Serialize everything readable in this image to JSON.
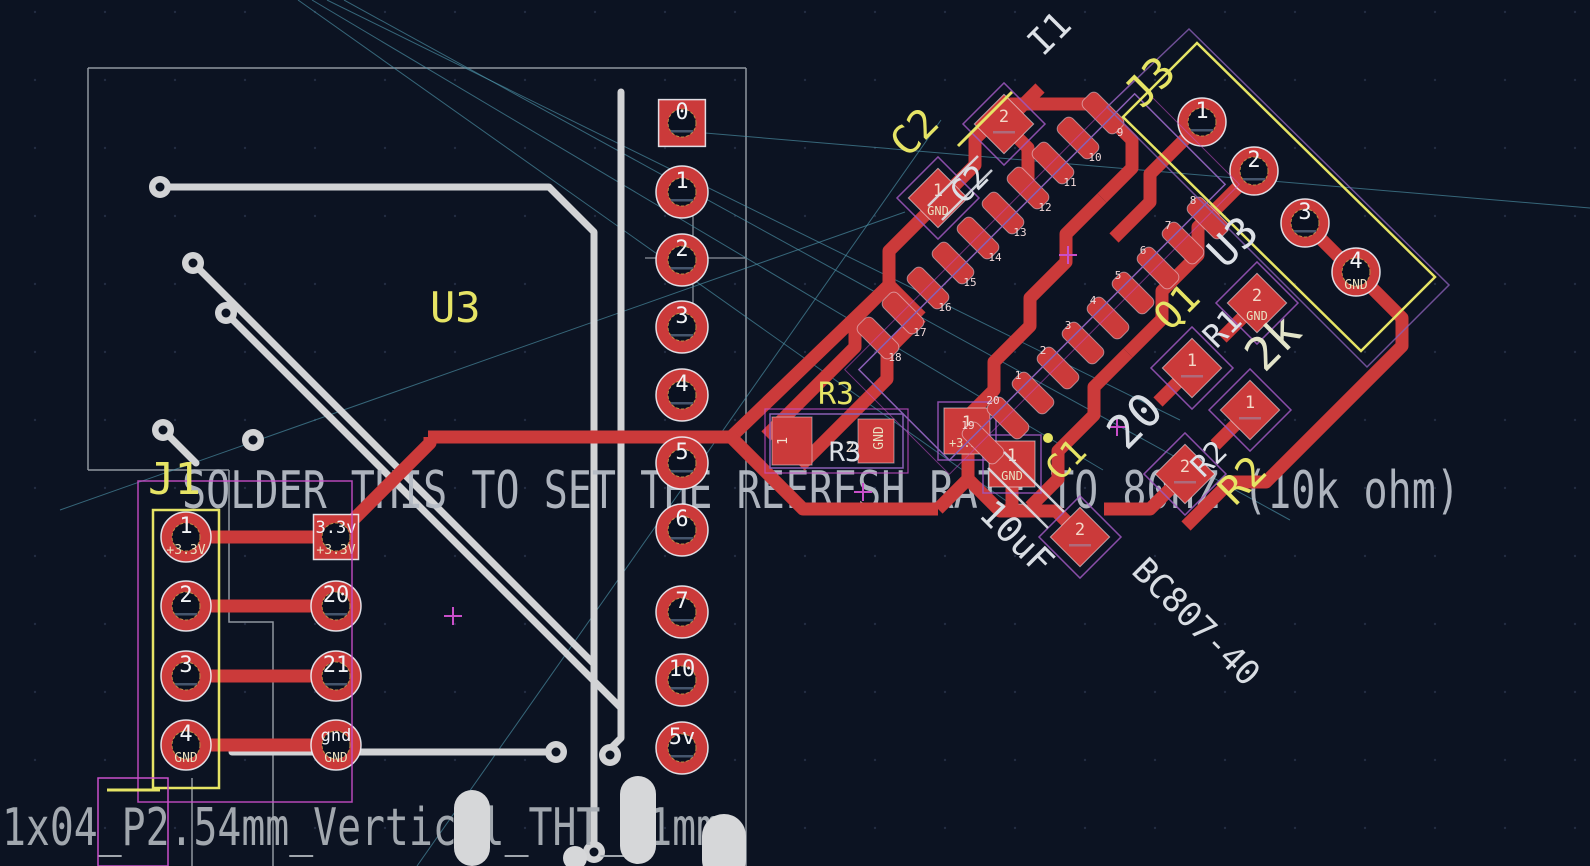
{
  "texts": {
    "solder_note": "SOLDER THIS TO SET THE REFRESH RATE TO 80HZ (10k ohm)",
    "footprint_name": "1x04_P2.54mm_Vertical_THT_D1mm"
  },
  "components": {
    "module_ref": "U3",
    "module_fab_ref": "U3",
    "j1_ref": "J1",
    "j3_ref": "J3",
    "c1_ref": "C1",
    "c1_value": "10uF",
    "c2_ref": "C2",
    "c2_fab_ref": "C2",
    "q1_ref": "Q1",
    "q1_value": "BC807-40",
    "r1_ref": "R1",
    "r1_value": "20",
    "r2_ref": "R2",
    "r2_fab_ref": "R2",
    "r2_value": "2k",
    "r3_ref": "R3",
    "r3_fab_ref": "R3",
    "i1_ref": "I1"
  },
  "header_pins": [
    "0",
    "1",
    "2",
    "3",
    "4",
    "5",
    "6",
    "7",
    "10",
    "5v"
  ],
  "j1_pads": [
    {
      "pin": "1",
      "net": "+3.3V"
    },
    {
      "pin": "2",
      "net": ""
    },
    {
      "pin": "3",
      "net": ""
    },
    {
      "pin": "4",
      "net": "GND"
    }
  ],
  "mcu_pads": [
    {
      "pin": "3.3v",
      "net": "+3.3V"
    },
    {
      "pin": "20",
      "net": ""
    },
    {
      "pin": "21",
      "net": ""
    },
    {
      "pin": "gnd",
      "net": "GND"
    }
  ],
  "j3_pads": [
    {
      "pin": "1",
      "net": ""
    },
    {
      "pin": "2",
      "net": ""
    },
    {
      "pin": "3",
      "net": ""
    },
    {
      "pin": "4",
      "net": "GND"
    }
  ],
  "smd_pads": [
    {
      "pin": "2",
      "net": ""
    },
    {
      "pin": "1",
      "net": "GND"
    },
    {
      "pin": "2",
      "net": ""
    },
    {
      "pin": "1",
      "net": ""
    },
    {
      "pin": "2",
      "net": "GND"
    },
    {
      "pin": "1",
      "net": ""
    },
    {
      "pin": "2",
      "net": ""
    }
  ],
  "sq_pads": [
    {
      "pin": "1",
      "net": "+3.3V"
    },
    {
      "pin": "1",
      "net": "GND"
    }
  ],
  "r3_pads": [
    {
      "pin": "1",
      "net": ""
    },
    {
      "pin": "2",
      "net": "GND"
    }
  ],
  "ic_row_a": [
    "9",
    "10",
    "11",
    "12",
    "13",
    "14",
    "15",
    "16",
    "17",
    "18"
  ],
  "ic_row_b": [
    "8",
    "7",
    "6",
    "5",
    "4",
    "3",
    "2",
    "1",
    "20",
    "19"
  ],
  "colors": {
    "background": "#0c1322",
    "copper_front": "#cb3a3a",
    "copper_back": "#d2d3d5",
    "silk_yellow": "#e6e465",
    "fab_white": "#dde1e7",
    "courtyard_magenta": "#c94fc9",
    "fab_purple": "#8a5fb5",
    "ratsnest": "#4d93a8",
    "annotation_gray": "#b6bcc6"
  }
}
